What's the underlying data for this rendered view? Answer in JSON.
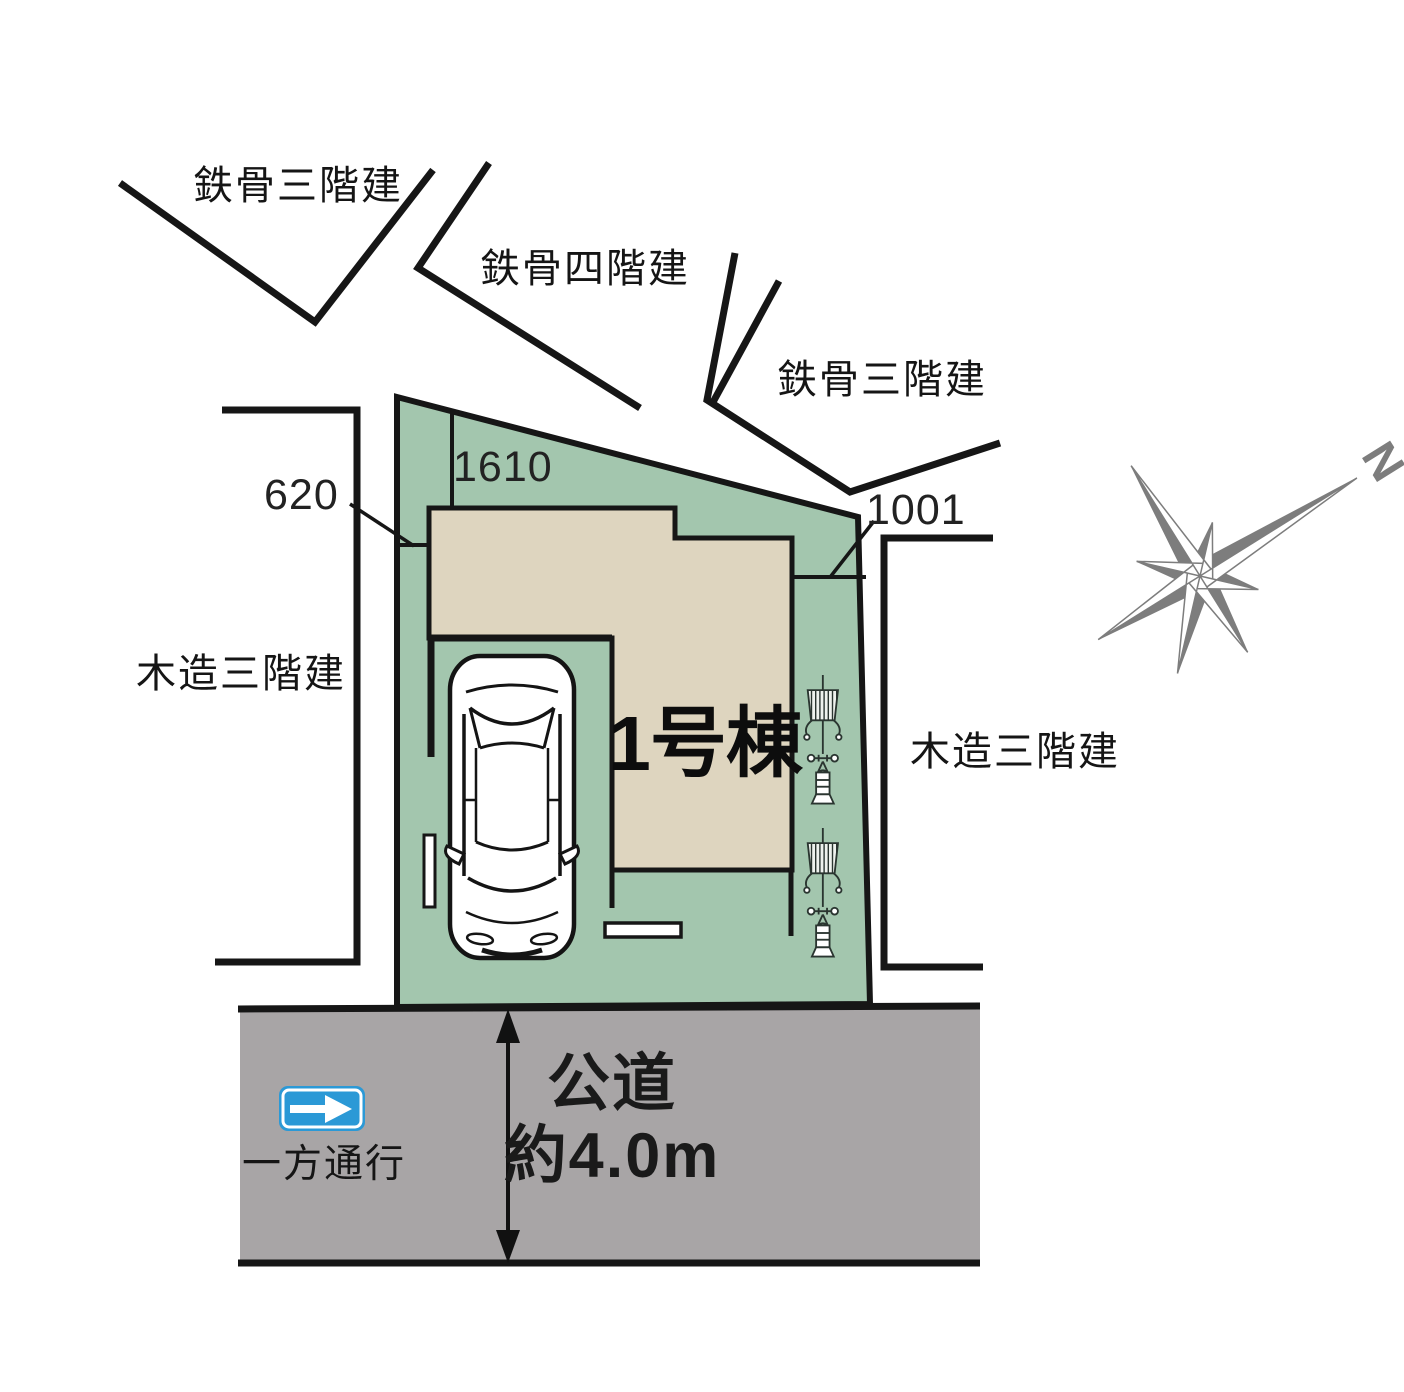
{
  "site_plan": {
    "unit": {
      "label": "1号棟"
    },
    "dimensions": {
      "top_edge": "1610",
      "left_side": "620",
      "right_side": "1001"
    },
    "road": {
      "type_label": "公道",
      "width_label": "約4.0m",
      "one_way_label": "一方通行"
    },
    "neighbors": {
      "top_left": "鉄骨三階建",
      "top_middle": "鉄骨四階建",
      "top_right": "鉄骨三階建",
      "left": "木造三階建",
      "right": "木造三階建"
    },
    "compass": {
      "north_label": "N"
    },
    "icons": [
      "car-top-view-icon",
      "garden-plant-icon",
      "compass-rose-icon",
      "one-way-sign-icon"
    ],
    "colors": {
      "plot_green": "#a3c6ae",
      "building_beige": "#ded5bf",
      "road_gray": "#a8a5a6",
      "outline_black": "#161616",
      "sign_blue": "#2b99d6",
      "compass_gray": "#7d7d7d"
    }
  }
}
